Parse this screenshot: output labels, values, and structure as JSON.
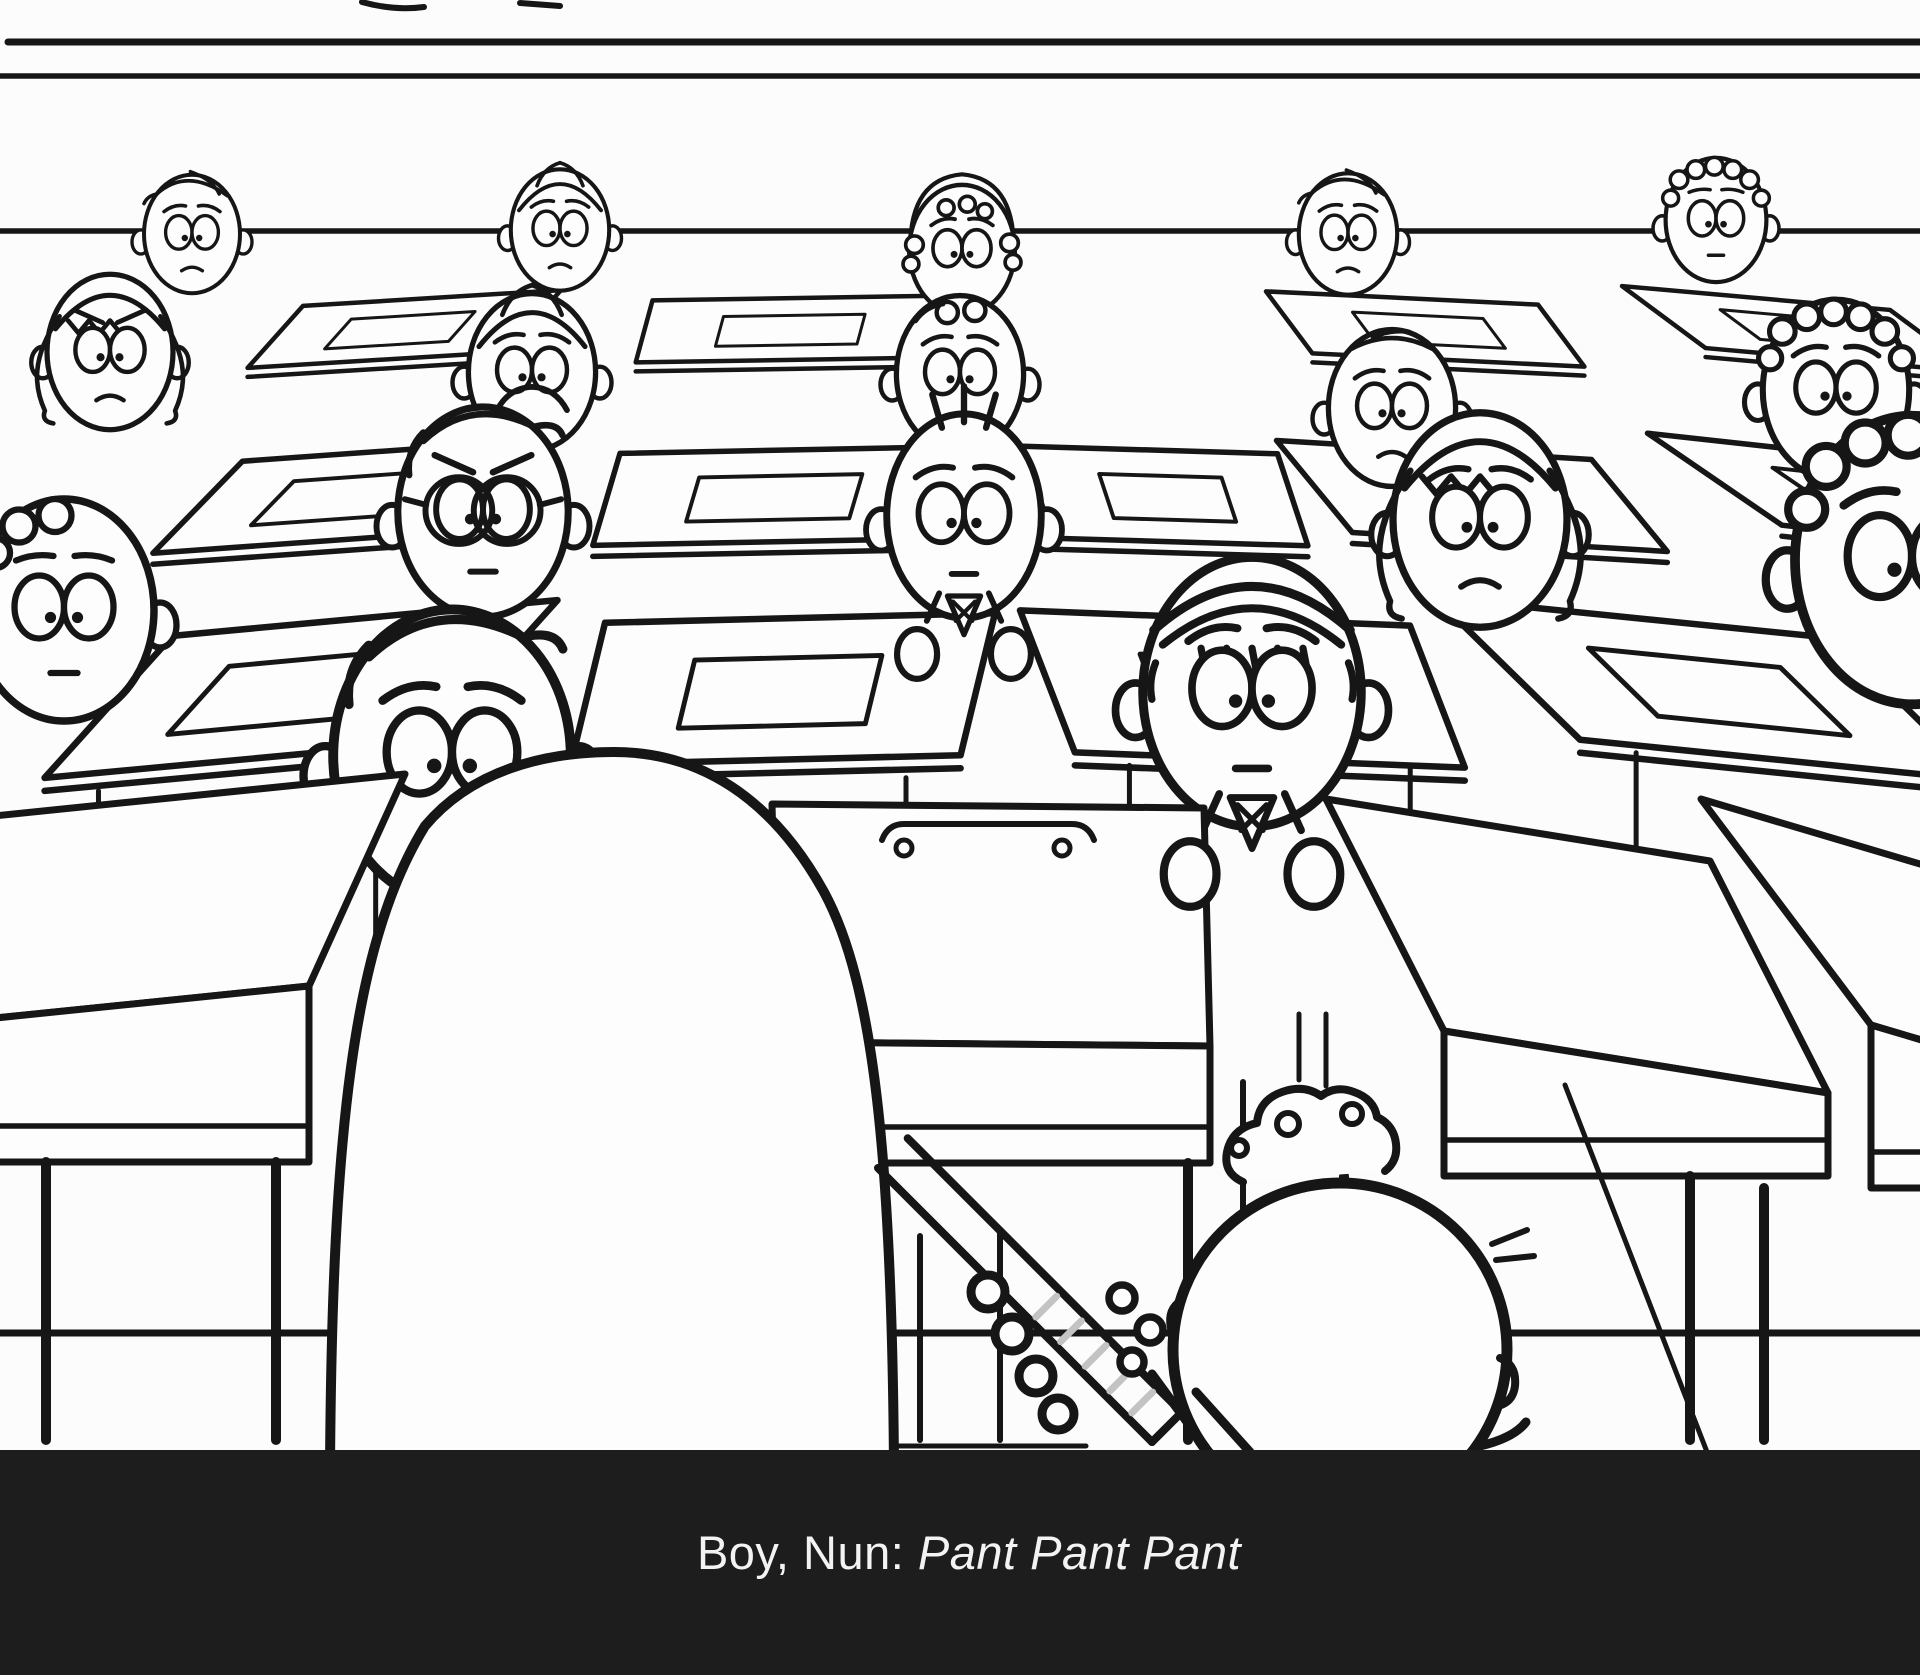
{
  "meta": {
    "kind": "storyboard-frame",
    "description": "Black-and-white hand-drawn storyboard of a classroom full of worried cartoon children seated at desks; a large nun seen from behind stands in the foreground at right of center-left, a small boy beside her grips a hatched strap; subtitle bar at bottom."
  },
  "colors": {
    "background": "#fcfcfc",
    "ink": "#161616",
    "paper": "#fdfdfd",
    "caption_bar": "#1d1d1d",
    "caption_text": "#f3f3f3",
    "hatch": "#c3c3c3"
  },
  "caption": {
    "speakers": "Boy, Nun: ",
    "line": "Pant Pant Pant"
  },
  "scene": {
    "wall": {
      "top_lines": [
        {
          "y": 42,
          "x1": 8,
          "x2": 1920,
          "sw": 7
        },
        {
          "y": 76,
          "x1": 0,
          "x2": 1920,
          "sw": 5.5
        }
      ],
      "ledge": {
        "y": 231,
        "x1": 0,
        "x2": 1920,
        "sw": 5.5
      },
      "top_marks": [
        {
          "d": "M 362,2 q 32,9 62,5",
          "sw": 6
        },
        {
          "d": "M 520,3 l 40,3",
          "sw": 6
        }
      ]
    },
    "desk_rows": [
      {
        "y0": 298,
        "h": 62,
        "sw": 4.5,
        "slab": 9,
        "shiftK": 0.105,
        "tiltK": 0.03,
        "paper": 0.5,
        "items": [
          {
            "cx": 432,
            "w": 258
          },
          {
            "cx": 800,
            "w": 295
          },
          {
            "cx": 1402,
            "w": 272
          },
          {
            "cx": 1756,
            "w": 268
          }
        ]
      },
      {
        "y0": 450,
        "h": 92,
        "sw": 5.5,
        "slab": 11,
        "shiftK": 0.16,
        "tiltK": 0.04,
        "paper": 0.52,
        "items": [
          {
            "cx": 400,
            "w": 315
          },
          {
            "cx": 790,
            "w": 340
          },
          {
            "cx": 1150,
            "w": 255
          },
          {
            "cx": 1434,
            "w": 315
          },
          {
            "cx": 1800,
            "w": 305
          }
        ]
      },
      {
        "y0": 618,
        "h": 142,
        "sw": 6.5,
        "slab": 13,
        "shiftK": 0.215,
        "tiltK": 0.06,
        "paper": 0.5,
        "legs": 158,
        "items": [
          {
            "cx": 365,
            "w": 385
          },
          {
            "cx": 800,
            "w": 390
          },
          {
            "cx": 1215,
            "w": 390
          },
          {
            "cx": 1635,
            "w": 400
          }
        ]
      }
    ],
    "front_desks": [
      {
        "cx": 170,
        "w": 470,
        "y0": 798,
        "h": 212,
        "faceTo": 1162,
        "tilt": -48,
        "shift": -96,
        "legs": [
          46,
          276
        ],
        "handle": false
      },
      {
        "cx": 988,
        "w": 432,
        "y0": 806,
        "h": 238,
        "faceTo": 1163,
        "tilt": 4,
        "shift": 6,
        "legs": [
          1188
        ],
        "handle": true
      },
      {
        "cx": 1518,
        "w": 384,
        "y0": 830,
        "h": 232,
        "faceTo": 1176,
        "tilt": 62,
        "shift": 118,
        "legs": [
          1344,
          1690
        ],
        "handle": false
      },
      {
        "cx": 1866,
        "w": 330,
        "y0": 848,
        "h": 226,
        "faceTo": 1188,
        "tilt": 98,
        "shift": 170,
        "legs": [
          1764
        ],
        "handle": false
      }
    ],
    "floor": {
      "lines": [
        {
          "y": 1333,
          "x1": 0,
          "x2": 1920,
          "sw": 7
        },
        {
          "y": 1446,
          "x1": 897,
          "x2": 1086,
          "sw": 5
        }
      ],
      "diagonal": {
        "x1": 1565,
        "y1": 1085,
        "x2": 1707,
        "y2": 1452,
        "sw": 5
      },
      "chair_legs": [
        [
          920,
          1236,
          1440
        ],
        [
          1000,
          1232,
          1440
        ],
        [
          1243,
          1082,
          1440
        ]
      ],
      "back_posts": [
        [
          1299,
          1014,
          1080
        ],
        [
          1326,
          1014,
          1086
        ]
      ]
    },
    "students": [
      {
        "id": "a1",
        "x": 192,
        "y": 234,
        "s": 0.8,
        "hair": "combover",
        "brows": "worried",
        "mouth": "frown"
      },
      {
        "id": "a2",
        "x": 560,
        "y": 230,
        "s": 0.82,
        "hair": "middlepart",
        "brows": "worried",
        "mouth": "frown"
      },
      {
        "id": "a3",
        "x": 962,
        "y": 250,
        "s": 0.88,
        "hair": "archcurls",
        "brows": "worried",
        "mouth": "none",
        "ears": false
      },
      {
        "id": "a4",
        "x": 1348,
        "y": 234,
        "s": 0.82,
        "hair": "combover",
        "brows": "worried",
        "mouth": "frown"
      },
      {
        "id": "a5",
        "x": 1716,
        "y": 220,
        "s": 0.84,
        "hair": "curly",
        "brows": "flat",
        "mouth": "flat"
      },
      {
        "id": "b1",
        "x": 110,
        "y": 352,
        "s": 1.05,
        "hair": "bangs",
        "brows": "angry",
        "mouth": "frown",
        "sides": true
      },
      {
        "id": "b2",
        "x": 532,
        "y": 372,
        "s": 1.06,
        "hair": "middlepart",
        "brows": "worried",
        "mouth": "bigfrown"
      },
      {
        "id": "b3",
        "x": 960,
        "y": 374,
        "s": 1.06,
        "hair": "twocurls",
        "brows": "worried",
        "mouth": "none"
      },
      {
        "id": "b4",
        "x": 1392,
        "y": 408,
        "s": 1.06,
        "hair": "flat",
        "brows": "worried",
        "mouth": "frown"
      },
      {
        "id": "b5",
        "x": 1836,
        "y": 390,
        "s": 1.22,
        "hair": "curly",
        "brows": "worried",
        "mouth": "none"
      },
      {
        "id": "c1",
        "x": 64,
        "y": 610,
        "s": 1.5,
        "hair": "curlside",
        "brows": "flat",
        "mouth": "flat"
      },
      {
        "id": "c2",
        "x": 483,
        "y": 512,
        "s": 1.42,
        "hair": "part",
        "brows": "angry",
        "mouth": "flat",
        "glasses": true
      },
      {
        "id": "c3",
        "x": 964,
        "y": 516,
        "s": 1.38,
        "rx": 56,
        "hair": "dashes",
        "brows": "worried",
        "mouth": "flat",
        "tie": true,
        "hands": true
      },
      {
        "id": "c4",
        "x": 1480,
        "y": 520,
        "s": 1.45,
        "hair": "bangs",
        "brows": "worried",
        "mouth": "frown",
        "sides": true
      },
      {
        "id": "c5",
        "x": 1912,
        "y": 560,
        "s": 1.95,
        "hair": "curly",
        "brows": "worried",
        "mouth": "none"
      },
      {
        "id": "d1",
        "x": 452,
        "y": 756,
        "s": 1.98,
        "hair": "part",
        "brows": "worried",
        "mouth": "none"
      },
      {
        "id": "d2",
        "x": 1252,
        "y": 692,
        "s": 1.82,
        "hair": "cap",
        "brows": "worried",
        "mouth": "flat",
        "tie": true,
        "hands": true,
        "handsLate": true
      }
    ],
    "nun": {
      "left": 330,
      "right": 894,
      "apexX": 614,
      "apexY": 752,
      "bottom": 1470,
      "sw": 10
    },
    "boy": {
      "cx": 1340,
      "cy": 1350,
      "r": 167,
      "sw": 11,
      "tuft": "M 1243,1182 q -22,-10 -15,-34 q 6,-20 29,-25 q 2,-23 25,-31 q 22,-8 39,4 q 15,-11 33,-4 q 20,7 23,25 q 17,8 19,27 q 2,17 -11,27",
      "tuft_loops": [
        [
          1288,
          1124,
          11
        ],
        [
          1352,
          1114,
          10
        ],
        [
          1239,
          1148,
          8
        ]
      ],
      "antennae": [
        "M 1492,1244 L 1527,1230",
        "M 1496,1260 L 1534,1256"
      ],
      "right_ear": "M 1500,1358 q 17,7 15,28 q -2,16 -17,20",
      "left_ear": "M 1182,1300 q -15,9 -11,28",
      "arms": [
        [
          1206,
          1448,
          1152,
          1374
        ],
        [
          1250,
          1452,
          1196,
          1392
        ]
      ],
      "right_arm": "M 1480,1446 q 34,-8 46,-24"
    },
    "strap": {
      "x1": 878,
      "y1": 1168,
      "x2": 1152,
      "y2": 1442,
      "w": 42,
      "sw": 8,
      "hatch_t": [
        0.56,
        0.65,
        0.74,
        0.83,
        0.91
      ],
      "nun_hand": [
        [
          988,
          1292,
          17
        ],
        [
          1012,
          1334,
          17
        ],
        [
          1036,
          1376,
          17
        ],
        [
          1058,
          1414,
          16
        ]
      ],
      "boy_hand": [
        [
          1122,
          1298,
          13
        ],
        [
          1150,
          1330,
          13
        ],
        [
          1132,
          1362,
          12
        ]
      ]
    }
  }
}
